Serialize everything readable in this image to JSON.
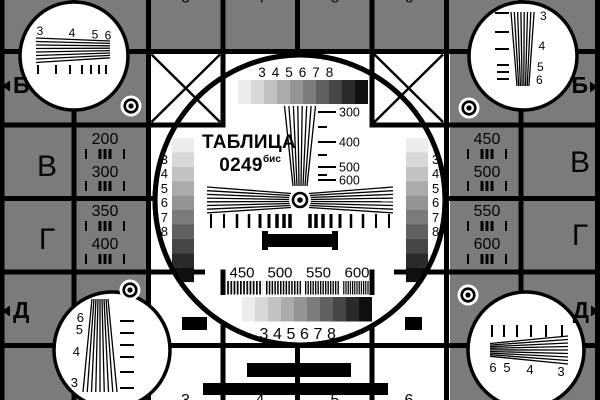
{
  "card": {
    "title": "ТАБЛИЦА",
    "number": "0249",
    "suffix": "бис"
  },
  "colors": {
    "background": "#7b7b7b",
    "panel": "#ffffff",
    "line": "#000000",
    "gray_ramp": [
      "#ececec",
      "#d8d8d8",
      "#c2c2c2",
      "#ababab",
      "#949494",
      "#7b7b7b",
      "#616161",
      "#464646",
      "#2a2a2a",
      "#0f0f0f"
    ]
  },
  "markers": {
    "left_top": "Б",
    "right_top": "Б",
    "left_bottom": "Д",
    "right_bottom": "Д"
  },
  "row_letters": {
    "left": [
      "В",
      "Г"
    ],
    "right": [
      "В",
      "Г"
    ]
  },
  "freq_cells": {
    "left_upper": [
      "200",
      "300"
    ],
    "left_lower": [
      "350",
      "400"
    ],
    "right_upper": [
      "450",
      "500"
    ],
    "right_lower": [
      "550",
      "600"
    ]
  },
  "scales": {
    "top": [
      "3",
      "4",
      "5",
      "6",
      "7",
      "8"
    ],
    "bottom": [
      "3",
      "4",
      "5",
      "6",
      "7",
      "8"
    ],
    "left": [
      "3",
      "4",
      "5",
      "6",
      "7",
      "8"
    ],
    "right": [
      "3",
      "4",
      "5",
      "6",
      "7",
      "8"
    ]
  },
  "ruler": [
    "300",
    "400",
    "500",
    "600"
  ],
  "bursts": [
    "450",
    "500",
    "550",
    "600"
  ],
  "corners": {
    "top_left": [
      "3",
      "4",
      "5",
      "6"
    ],
    "top_right": [
      "3",
      "4",
      "5",
      "6"
    ],
    "bottom_left": [
      "6",
      "5",
      "4",
      "3"
    ],
    "bottom_right": [
      "6",
      "5",
      "4",
      "3"
    ]
  },
  "edge_digits": [
    "3",
    "4",
    "5",
    "6"
  ]
}
